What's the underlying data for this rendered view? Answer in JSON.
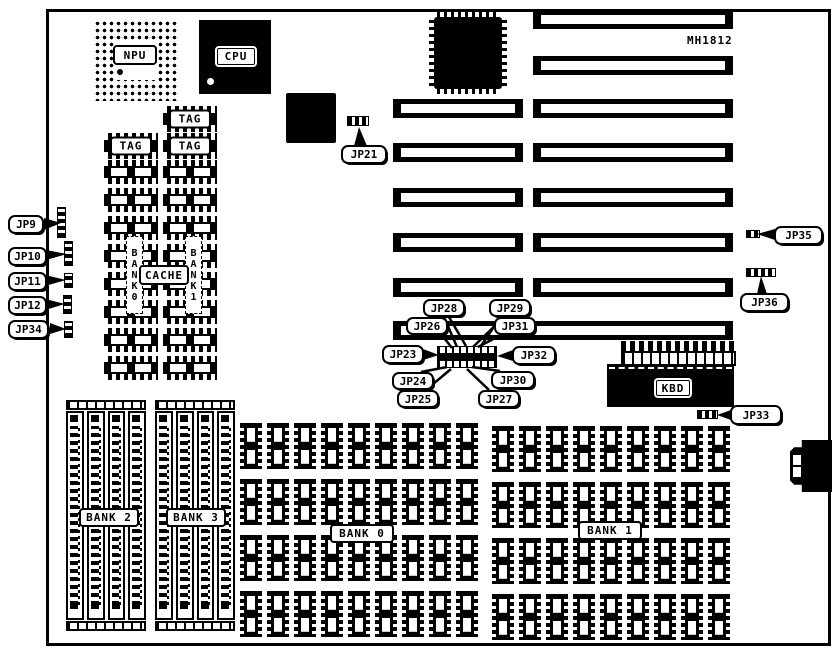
{
  "board": {
    "model_label": "MH1812",
    "foreground_color": "#000000",
    "background_color": "#ffffff"
  },
  "chips": {
    "npu": "NPU",
    "cpu": "CPU",
    "tag1": "TAG",
    "tag2": "TAG",
    "tag3": "TAG",
    "cache": "CACHE",
    "kbd": "KBD"
  },
  "memory": {
    "cache_bank0_vertical": "BANK0",
    "cache_bank1_vertical": "BANK1",
    "bank0": "BANK 0",
    "bank1": "BANK 1",
    "bank2": "BANK 2",
    "bank3": "BANK 3"
  },
  "jumpers": {
    "jp9": "JP9",
    "jp10": "JP10",
    "jp11": "JP11",
    "jp12": "JP12",
    "jp21": "JP21",
    "jp23": "JP23",
    "jp24": "JP24",
    "jp25": "JP25",
    "jp26": "JP26",
    "jp27": "JP27",
    "jp28": "JP28",
    "jp29": "JP29",
    "jp30": "JP30",
    "jp31": "JP31",
    "jp32": "JP32",
    "jp33": "JP33",
    "jp34": "JP34",
    "jp35": "JP35",
    "jp36": "JP36"
  }
}
